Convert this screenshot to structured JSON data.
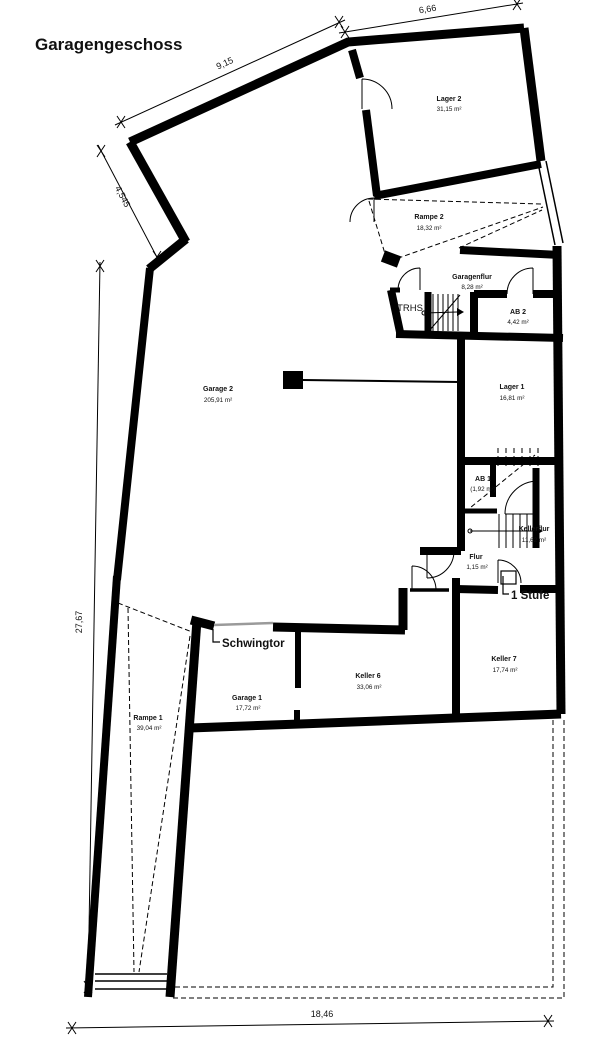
{
  "title": "Garagengeschoss",
  "dimensions": {
    "top_left_wall": "9,15",
    "top_right_wall": "6,66",
    "upper_left_diagonal": "4,545",
    "left_side": "27,67",
    "bottom": "18,46"
  },
  "rooms": {
    "lager2": {
      "name": "Lager 2",
      "area": "31,15 m²"
    },
    "rampe2": {
      "name": "Rampe 2",
      "area": "18,32 m²"
    },
    "garagenflur": {
      "name": "Garagenflur",
      "area": "8,28 m²"
    },
    "ab2": {
      "name": "AB 2",
      "area": "4,42 m²"
    },
    "lager1": {
      "name": "Lager 1",
      "area": "16,81 m²"
    },
    "garage2": {
      "name": "Garage 2",
      "area": "205,91 m²"
    },
    "ab1": {
      "name": "AB 1",
      "area": "(1,92 m²)"
    },
    "kellerflur": {
      "name": "Kellerflur",
      "area": "11,62 m²"
    },
    "flur": {
      "name": "Flur",
      "area": "1,15 m²"
    },
    "keller7": {
      "name": "Keller 7",
      "area": "17,74 m²"
    },
    "keller6": {
      "name": "Keller 6",
      "area": "33,06 m²"
    },
    "garage1": {
      "name": "Garage 1",
      "area": "17,72 m²"
    },
    "rampe1": {
      "name": "Rampe 1",
      "area": "39,04 m²"
    }
  },
  "annotations": {
    "stairwell": "TRHS",
    "garage_gate": "Schwingtor",
    "step": "1 Stufe"
  },
  "colors": {
    "walls": "#000000",
    "background": "#ffffff",
    "gate_line": "#9a9a9a"
  }
}
